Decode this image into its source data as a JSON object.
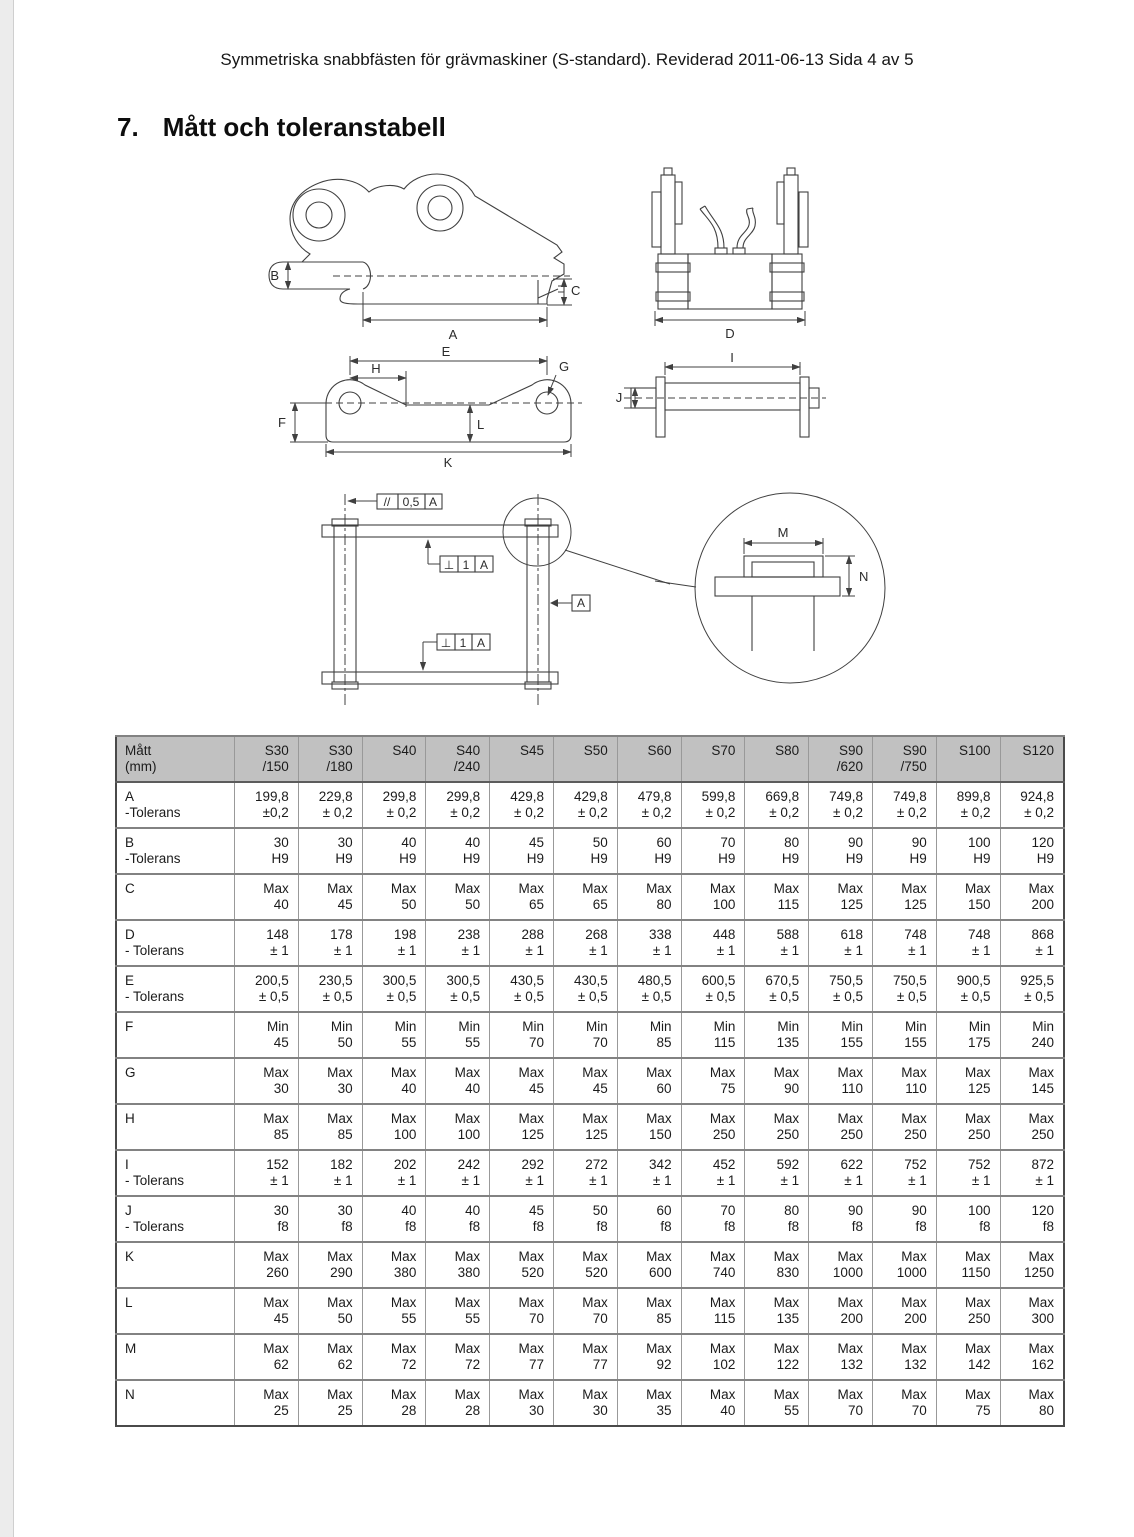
{
  "page": {
    "header_line": "Symmetriska snabbfästen för grävmaskiner (S-standard). Reviderad 2011-06-13 Sida 4 av 5",
    "section_number": "7.",
    "section_title": "Mått och toleranstabell"
  },
  "drawings": {
    "labels": {
      "A": "A",
      "B": "B",
      "C": "C",
      "D": "D",
      "E": "E",
      "F": "F",
      "G": "G",
      "H": "H",
      "I": "I",
      "J": "J",
      "K": "K",
      "L": "L",
      "M": "M",
      "N": "N"
    },
    "frame_parallelism": {
      "symbol": "//",
      "value": "0,5",
      "datum": "A"
    },
    "frame_perpendicularity_upper": {
      "symbol": "⊥",
      "value": "1",
      "datum": "A"
    },
    "frame_perpendicularity_lower": {
      "symbol": "⊥",
      "value": "1",
      "datum": "A"
    },
    "datum_label": "A"
  },
  "table": {
    "columns": [
      [
        "Mått",
        "(mm)"
      ],
      [
        "S30",
        "/150"
      ],
      [
        "S30",
        "/180"
      ],
      [
        "S40",
        ""
      ],
      [
        "S40",
        "/240"
      ],
      [
        "S45",
        ""
      ],
      [
        "S50",
        ""
      ],
      [
        "S60",
        ""
      ],
      [
        "S70",
        ""
      ],
      [
        "S80",
        ""
      ],
      [
        "S90",
        "/620"
      ],
      [
        "S90",
        "/750"
      ],
      [
        "S100",
        ""
      ],
      [
        "S120",
        ""
      ]
    ],
    "rows": [
      {
        "label": [
          "A",
          "-Tolerans"
        ],
        "top": [
          "199,8",
          "229,8",
          "299,8",
          "299,8",
          "429,8",
          "429,8",
          "479,8",
          "599,8",
          "669,8",
          "749,8",
          "749,8",
          "899,8",
          "924,8"
        ],
        "bottom": [
          "±0,2",
          "± 0,2",
          "± 0,2",
          "± 0,2",
          "± 0,2",
          "± 0,2",
          "± 0,2",
          "± 0,2",
          "± 0,2",
          "± 0,2",
          "± 0,2",
          "± 0,2",
          "± 0,2"
        ]
      },
      {
        "label": [
          "B",
          "-Tolerans"
        ],
        "top": [
          "30",
          "30",
          "40",
          "40",
          "45",
          "50",
          "60",
          "70",
          "80",
          "90",
          "90",
          "100",
          "120"
        ],
        "bottom": [
          "H9",
          "H9",
          "H9",
          "H9",
          "H9",
          "H9",
          "H9",
          "H9",
          "H9",
          "H9",
          "H9",
          "H9",
          "H9"
        ]
      },
      {
        "label": [
          "C",
          ""
        ],
        "top": [
          "Max",
          "Max",
          "Max",
          "Max",
          "Max",
          "Max",
          "Max",
          "Max",
          "Max",
          "Max",
          "Max",
          "Max",
          "Max"
        ],
        "bottom": [
          "40",
          "45",
          "50",
          "50",
          "65",
          "65",
          "80",
          "100",
          "115",
          "125",
          "125",
          "150",
          "200"
        ]
      },
      {
        "label": [
          "D",
          "- Tolerans"
        ],
        "top": [
          "148",
          "178",
          "198",
          "238",
          "288",
          "268",
          "338",
          "448",
          "588",
          "618",
          "748",
          "748",
          "868"
        ],
        "bottom": [
          "± 1",
          "± 1",
          "± 1",
          "± 1",
          "± 1",
          "± 1",
          "± 1",
          "± 1",
          "± 1",
          "± 1",
          "± 1",
          "± 1",
          "± 1"
        ]
      },
      {
        "label": [
          "E",
          "- Tolerans"
        ],
        "top": [
          "200,5",
          "230,5",
          "300,5",
          "300,5",
          "430,5",
          "430,5",
          "480,5",
          "600,5",
          "670,5",
          "750,5",
          "750,5",
          "900,5",
          "925,5"
        ],
        "bottom": [
          "± 0,5",
          "± 0,5",
          "± 0,5",
          "± 0,5",
          "± 0,5",
          "± 0,5",
          "± 0,5",
          "± 0,5",
          "± 0,5",
          "± 0,5",
          "± 0,5",
          "± 0,5",
          "± 0,5"
        ]
      },
      {
        "label": [
          "F",
          ""
        ],
        "top": [
          "Min",
          "Min",
          "Min",
          "Min",
          "Min",
          "Min",
          "Min",
          "Min",
          "Min",
          "Min",
          "Min",
          "Min",
          "Min"
        ],
        "bottom": [
          "45",
          "50",
          "55",
          "55",
          "70",
          "70",
          "85",
          "115",
          "135",
          "155",
          "155",
          "175",
          "240"
        ]
      },
      {
        "label": [
          "G",
          ""
        ],
        "top": [
          "Max",
          "Max",
          "Max",
          "Max",
          "Max",
          "Max",
          "Max",
          "Max",
          "Max",
          "Max",
          "Max",
          "Max",
          "Max"
        ],
        "bottom": [
          "30",
          "30",
          "40",
          "40",
          "45",
          "45",
          "60",
          "75",
          "90",
          "110",
          "110",
          "125",
          "145"
        ]
      },
      {
        "label": [
          "H",
          ""
        ],
        "top": [
          "Max",
          "Max",
          "Max",
          "Max",
          "Max",
          "Max",
          "Max",
          "Max",
          "Max",
          "Max",
          "Max",
          "Max",
          "Max"
        ],
        "bottom": [
          "85",
          "85",
          "100",
          "100",
          "125",
          "125",
          "150",
          "250",
          "250",
          "250",
          "250",
          "250",
          "250"
        ]
      },
      {
        "label": [
          "I",
          "- Tolerans"
        ],
        "top": [
          "152",
          "182",
          "202",
          "242",
          "292",
          "272",
          "342",
          "452",
          "592",
          "622",
          "752",
          "752",
          "872"
        ],
        "bottom": [
          "± 1",
          "± 1",
          "± 1",
          "± 1",
          "± 1",
          "± 1",
          "± 1",
          "± 1",
          "± 1",
          "± 1",
          "± 1",
          "± 1",
          "± 1"
        ]
      },
      {
        "label": [
          "J",
          "- Tolerans"
        ],
        "top": [
          "30",
          "30",
          "40",
          "40",
          "45",
          "50",
          "60",
          "70",
          "80",
          "90",
          "90",
          "100",
          "120"
        ],
        "bottom": [
          "f8",
          "f8",
          "f8",
          "f8",
          "f8",
          "f8",
          "f8",
          "f8",
          "f8",
          "f8",
          "f8",
          "f8",
          "f8"
        ]
      },
      {
        "label": [
          "K",
          ""
        ],
        "top": [
          "Max",
          "Max",
          "Max",
          "Max",
          "Max",
          "Max",
          "Max",
          "Max",
          "Max",
          "Max",
          "Max",
          "Max",
          "Max"
        ],
        "bottom": [
          "260",
          "290",
          "380",
          "380",
          "520",
          "520",
          "600",
          "740",
          "830",
          "1000",
          "1000",
          "1150",
          "1250"
        ]
      },
      {
        "label": [
          "L",
          ""
        ],
        "top": [
          "Max",
          "Max",
          "Max",
          "Max",
          "Max",
          "Max",
          "Max",
          "Max",
          "Max",
          "Max",
          "Max",
          "Max",
          "Max"
        ],
        "bottom": [
          "45",
          "50",
          "55",
          "55",
          "70",
          "70",
          "85",
          "115",
          "135",
          "200",
          "200",
          "250",
          "300"
        ]
      },
      {
        "label": [
          "M",
          ""
        ],
        "top": [
          "Max",
          "Max",
          "Max",
          "Max",
          "Max",
          "Max",
          "Max",
          "Max",
          "Max",
          "Max",
          "Max",
          "Max",
          "Max"
        ],
        "bottom": [
          "62",
          "62",
          "72",
          "72",
          "77",
          "77",
          "92",
          "102",
          "122",
          "132",
          "132",
          "142",
          "162"
        ]
      },
      {
        "label": [
          "N",
          ""
        ],
        "top": [
          "Max",
          "Max",
          "Max",
          "Max",
          "Max",
          "Max",
          "Max",
          "Max",
          "Max",
          "Max",
          "Max",
          "Max",
          "Max"
        ],
        "bottom": [
          "25",
          "25",
          "28",
          "28",
          "30",
          "30",
          "35",
          "40",
          "55",
          "70",
          "70",
          "75",
          "80"
        ]
      }
    ]
  }
}
